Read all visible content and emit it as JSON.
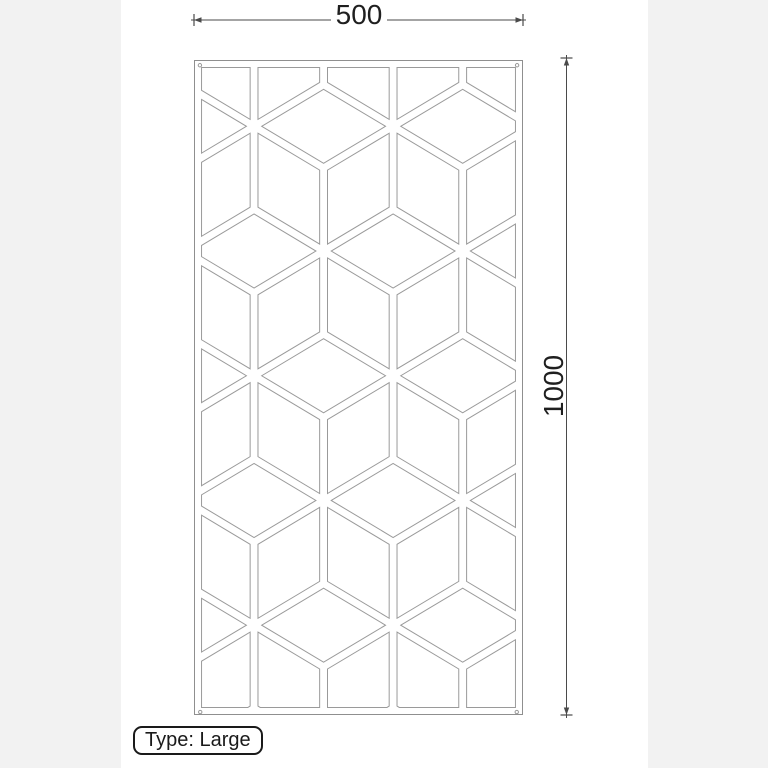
{
  "page": {
    "side_band_color": "#f2f2f2",
    "canvas_color": "#ffffff"
  },
  "drawing": {
    "panel": {
      "border_color": "#8f8f8f",
      "pattern_line_color": "#9a9a9a",
      "screw_hole_radius": 2.6,
      "screw_holes": [
        [
          7.5,
          6.5
        ],
        [
          492.5,
          6.5
        ],
        [
          8,
          997
        ],
        [
          492,
          997
        ]
      ],
      "pattern": {
        "type": "isometric-cube-lattice",
        "units_w": 500,
        "units_h": 1000,
        "col_period": 212.65,
        "row_period": 191,
        "first_row_y": 100,
        "first_col_x": 90.3,
        "strip_inset": 6,
        "edge_margin": 10
      }
    },
    "dimensions": {
      "color": "#4a4a4a",
      "text_color": "#1f1f1f",
      "width": {
        "label": "500"
      },
      "height": {
        "label": "1000"
      }
    },
    "type_label": {
      "text": "Type: Large"
    }
  }
}
